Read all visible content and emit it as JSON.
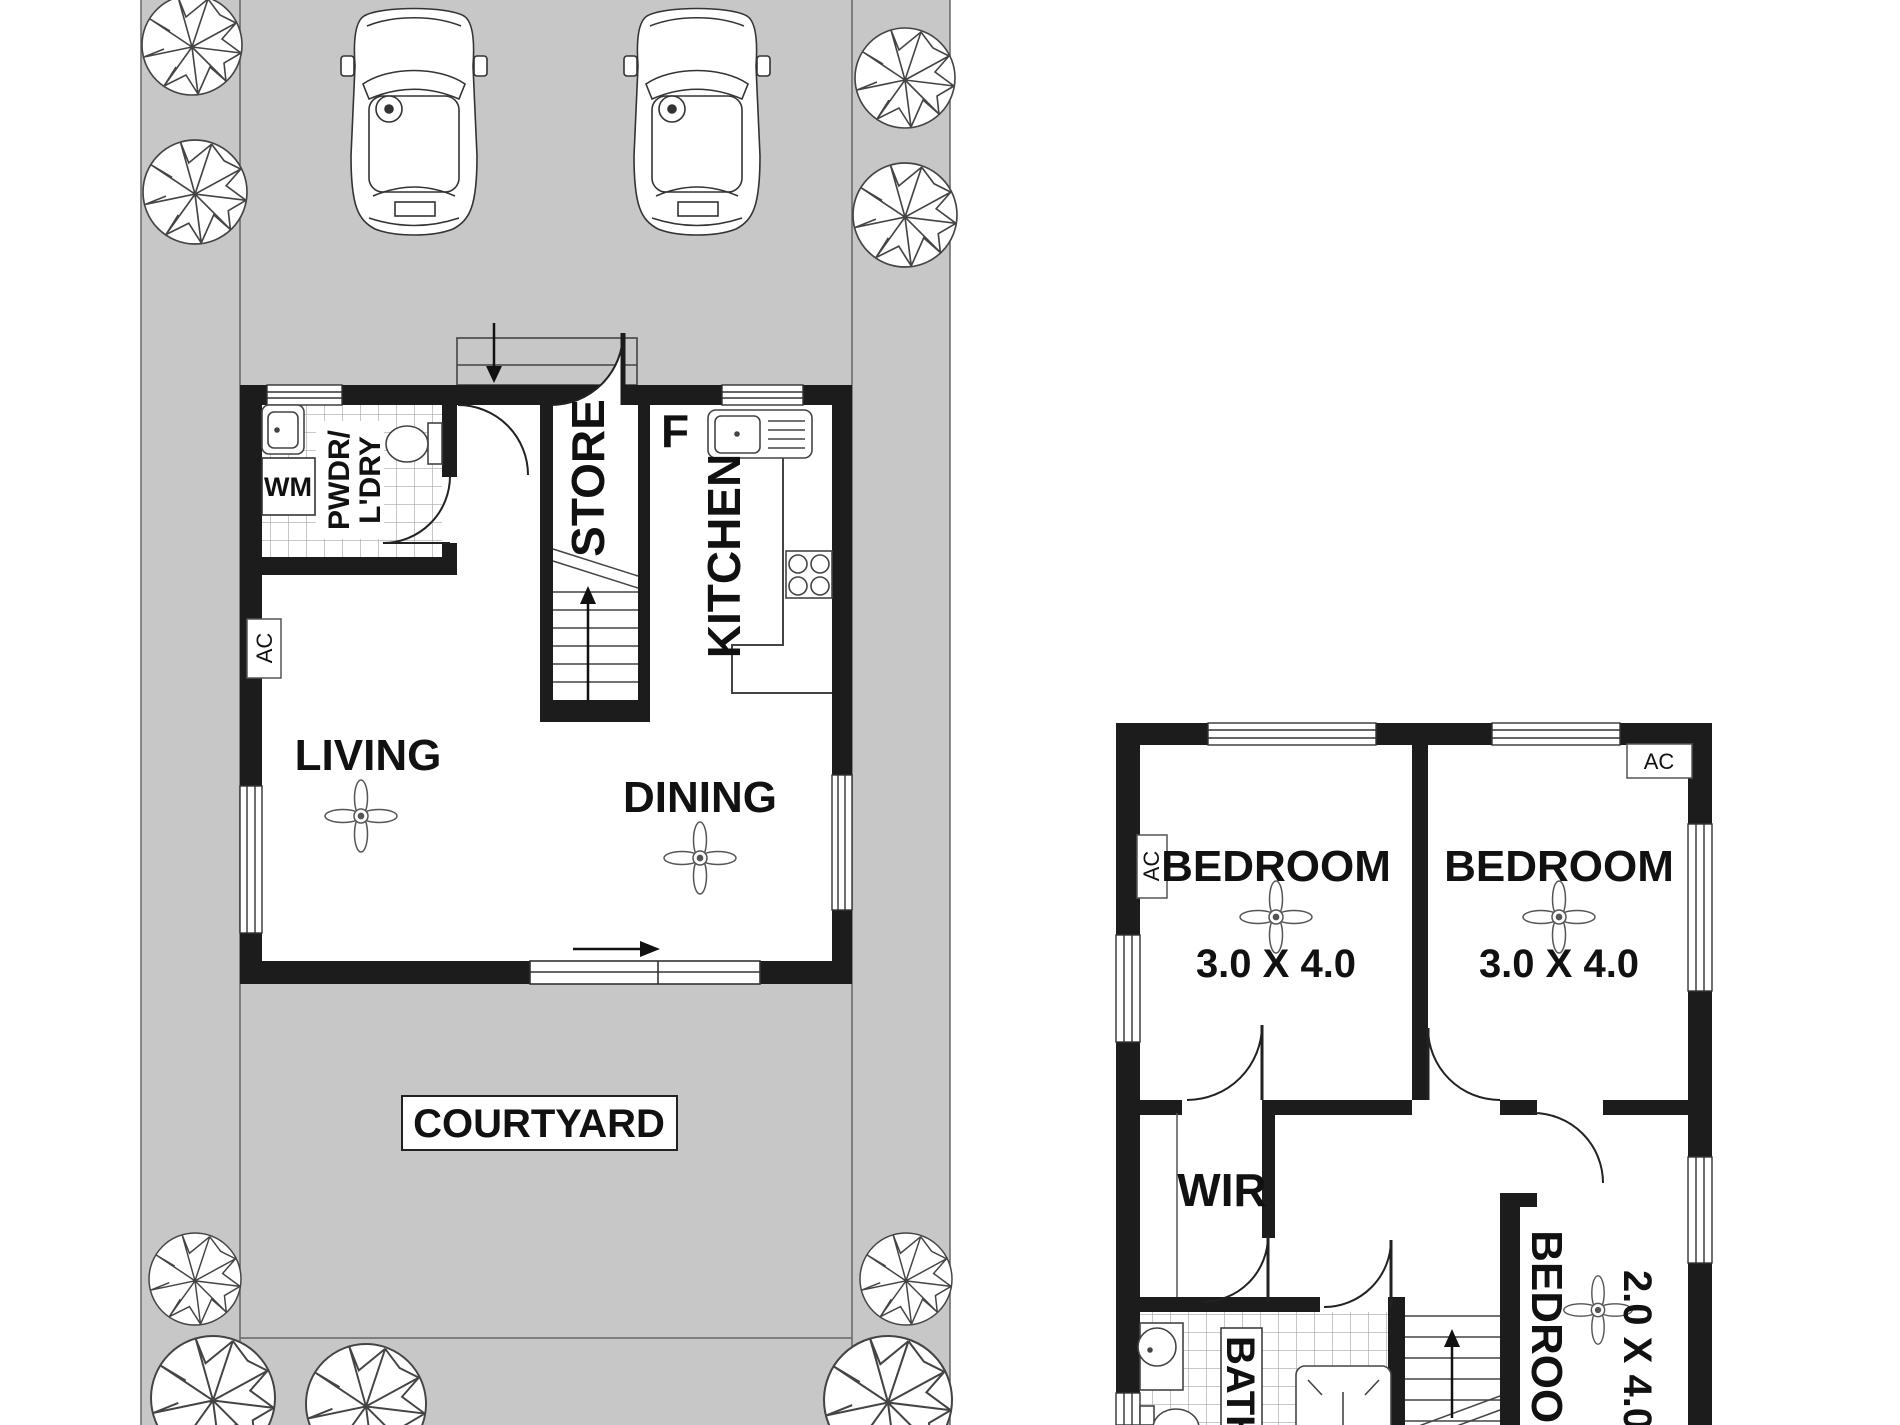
{
  "colors": {
    "site_gray": "#c7c7c7",
    "wall_black": "#1c1c1c",
    "line_gray": "#555555",
    "tile_gray": "#a8a8a8"
  },
  "ground_floor": {
    "living": "LIVING",
    "dining": "DINING",
    "kitchen": "KITCHEN",
    "store": "STORE",
    "fridge": "F",
    "washing_machine": "WM",
    "ac": "AC",
    "powder_line1": "PWDR/",
    "powder_line2": "L'DRY",
    "courtyard": "COURTYARD"
  },
  "upper_floor": {
    "bedroom1": {
      "name": "BEDROOM",
      "dim": "3.0 X 4.0"
    },
    "bedroom2": {
      "name": "BEDROOM",
      "dim": "3.0 X 4.0"
    },
    "bedroom3": {
      "name": "BEDROOM",
      "dim": "2.0 X 4.0"
    },
    "wir": "WIR",
    "bath": "BATH",
    "ac_wall": "AC",
    "ac_corner": "AC"
  }
}
